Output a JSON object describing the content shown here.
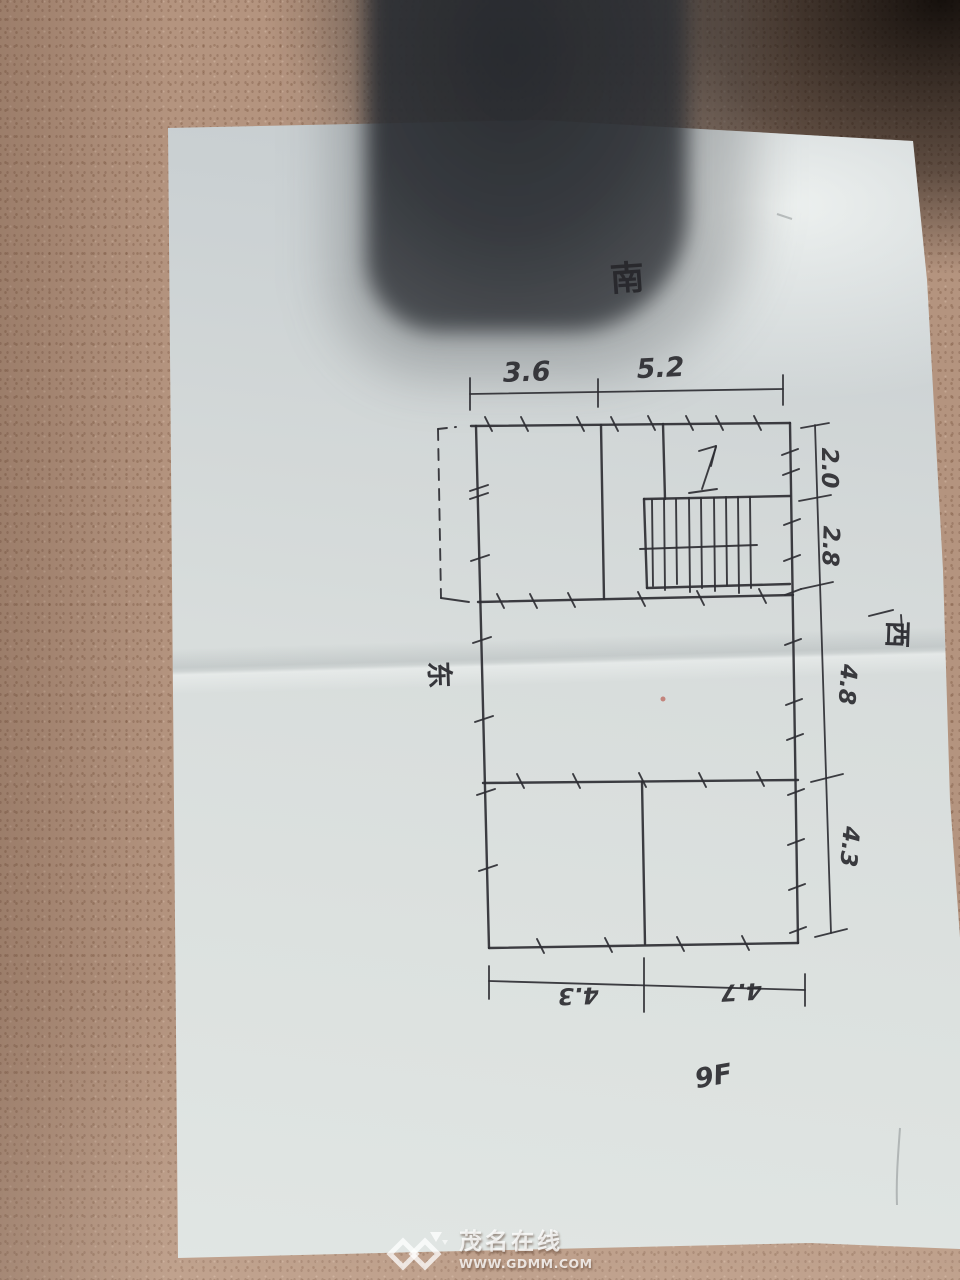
{
  "scene": {
    "description": "Photo of a hand-drawn floor plan sketch on paper lying on a speckled tan desk with a dark object shadow at top",
    "colors": {
      "ink": "#2e2e33",
      "paper": "#d9dedd",
      "table": "#b4947f",
      "shadow": "#2f3338",
      "watermark": "#ffffff"
    }
  },
  "plan": {
    "orientation": {
      "south": "南",
      "east": "东",
      "west": "西"
    },
    "top_dimensions": {
      "left": "3.6",
      "right": "5.2"
    },
    "right_dimensions": {
      "d1": "2.0",
      "d2": "2.8",
      "d3": "4.8",
      "d4": "4.3"
    },
    "bottom_dimensions": {
      "left": "4.3",
      "right": "4.7"
    },
    "floor_label": "9F",
    "features": {
      "staircase": "staircase with up-direction arrow",
      "balcony_outline": "dashed rectangle upper-left"
    }
  },
  "watermark": {
    "site_name": "茂名在线",
    "url": "WWW.GDMM.COM"
  }
}
